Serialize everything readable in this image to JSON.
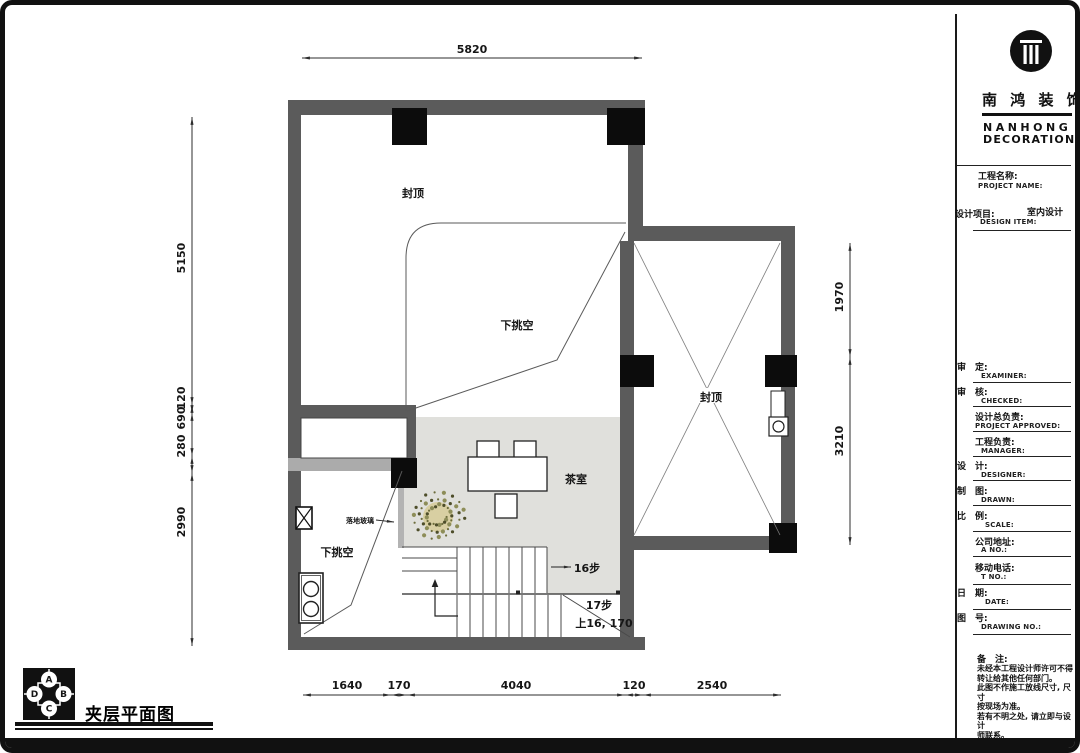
{
  "plan": {
    "dimensions": {
      "top": "5820",
      "left": [
        "5150",
        "120",
        "690",
        "280",
        "2990"
      ],
      "right": [
        "1970",
        "3210"
      ],
      "bottom": [
        "1640",
        "170",
        "4040",
        "120",
        "2540"
      ]
    },
    "labels": {
      "capped_main": "封顶",
      "void_main": "下挑空",
      "capped_right": "封顶",
      "tea_room": "茶室",
      "floor_glass": "落地玻璃",
      "void_lower": "下挑空",
      "steps_16": "16步",
      "steps_17": "17步",
      "up_note": "上16, 170"
    }
  },
  "title_block": {
    "company_cn": "南 鸿 装 饰",
    "company_en_1": "NANHONG",
    "company_en_2": "DECORATION",
    "project_name_cn": "工程名称:",
    "project_name_en": "PROJECT NAME:",
    "design_item_cn": "设计项目:",
    "design_item_en": "DESIGN ITEM:",
    "design_item_value": "室内设计",
    "fields": [
      {
        "cn": "审　定:",
        "en": "EXAMINER:"
      },
      {
        "cn": "审　核:",
        "en": "CHECKED:"
      },
      {
        "cn": "设计总负责:",
        "en": "PROJECT APPROVED:"
      },
      {
        "cn": "工程负责:",
        "en": "MANAGER:"
      },
      {
        "cn": "设　计:",
        "en": "DESIGNER:"
      },
      {
        "cn": "制　图:",
        "en": "DRAWN:"
      },
      {
        "cn": "比　例:",
        "en": "SCALE:"
      },
      {
        "cn": "公司地址:",
        "en": "A  NO.:"
      },
      {
        "cn": "移动电话:",
        "en": "T  NO.:"
      },
      {
        "cn": "日　期:",
        "en": "DATE:"
      },
      {
        "cn": "图　号:",
        "en": "DRAWING NO.:"
      }
    ],
    "notes_title": "备　注:",
    "notes_lines": [
      "未经本工程设计师许可不得",
      "转让给其他任何部门。",
      "此图不作施工放线尺寸, 尺寸",
      "按现场为准。",
      "若有不明之处, 请立即与设计",
      "师联系。"
    ]
  },
  "footer": {
    "drawing_title": "夹层平面图",
    "compass": {
      "top": "A",
      "right": "B",
      "bottom": "C",
      "left": "D"
    }
  }
}
